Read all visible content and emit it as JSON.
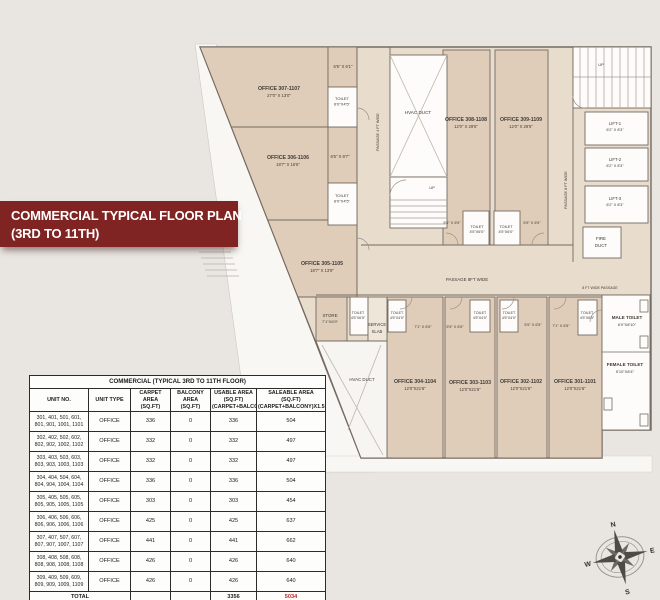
{
  "banner": {
    "line1": "COMMERCIAL TYPICAL FLOOR PLAN",
    "line2": "(3RD TO 11TH)"
  },
  "table": {
    "title": "COMMERCIAL (TYPICAL 3RD TO 11TH FLOOR)",
    "columns": [
      [
        "UNIT NO.",
        ""
      ],
      [
        "UNIT TYPE",
        ""
      ],
      [
        "CARPET AREA",
        "(SQ.FT)"
      ],
      [
        "BALCONY AREA",
        "(SQ.FT)"
      ],
      [
        "USABLE AREA (SQ.FT)",
        "(CARPET+BALCONY)"
      ],
      [
        "SALEABLE AREA (SQ.FT)",
        "(CARPET+BALCONY)X1.5"
      ]
    ],
    "rows": [
      {
        "units": "301, 401, 501, 601, 801, 901, 1001, 1101",
        "type": "OFFICE",
        "carpet": "336",
        "balcony": "0",
        "usable": "336",
        "saleable": "504"
      },
      {
        "units": "302, 402, 502, 602, 802, 902, 1002, 1102",
        "type": "OFFICE",
        "carpet": "332",
        "balcony": "0",
        "usable": "332",
        "saleable": "497"
      },
      {
        "units": "303, 403, 503, 603, 803, 903, 1003, 1103",
        "type": "OFFICE",
        "carpet": "332",
        "balcony": "0",
        "usable": "332",
        "saleable": "497"
      },
      {
        "units": "304, 404, 504, 604, 804, 904, 1004, 1104",
        "type": "OFFICE",
        "carpet": "336",
        "balcony": "0",
        "usable": "336",
        "saleable": "504"
      },
      {
        "units": "305, 405, 505, 605, 805, 905, 1005, 1105",
        "type": "OFFICE",
        "carpet": "303",
        "balcony": "0",
        "usable": "303",
        "saleable": "454"
      },
      {
        "units": "306, 406, 506, 606, 806, 906, 1006, 1106",
        "type": "OFFICE",
        "carpet": "425",
        "balcony": "0",
        "usable": "425",
        "saleable": "637"
      },
      {
        "units": "307, 407, 507, 607, 807, 907, 1007, 1107",
        "type": "OFFICE",
        "carpet": "441",
        "balcony": "0",
        "usable": "441",
        "saleable": "662"
      },
      {
        "units": "308, 408, 508, 608, 808, 908, 1008, 1108",
        "type": "OFFICE",
        "carpet": "426",
        "balcony": "0",
        "usable": "426",
        "saleable": "640"
      },
      {
        "units": "309, 409, 509, 609, 809, 909, 1009, 1109",
        "type": "OFFICE",
        "carpet": "426",
        "balcony": "0",
        "usable": "426",
        "saleable": "640"
      }
    ],
    "total": {
      "label": "TOTAL",
      "usable": "3356",
      "saleable": "5034"
    }
  },
  "plan": {
    "labels": [
      {
        "n": "dim-307-nook",
        "t": "6'5\" X 6'1\"",
        "x": 343,
        "y": 68,
        "s": 4.2
      },
      {
        "n": "office-307-name",
        "t": "OFFICE 307-1107",
        "x": 279,
        "y": 90,
        "s": 5.2,
        "b": 1
      },
      {
        "n": "office-307-dim",
        "t": "27'0\" X 13'0\"",
        "x": 279,
        "y": 97,
        "s": 4.2
      },
      {
        "n": "toilet-307-name",
        "t": "TOILET",
        "x": 342,
        "y": 100,
        "s": 4
      },
      {
        "n": "toilet-307-dim",
        "t": "6'0\"X4'5\"",
        "x": 342,
        "y": 105.5,
        "s": 4
      },
      {
        "n": "office-306-name",
        "t": "OFFICE 306-1106",
        "x": 288,
        "y": 159,
        "s": 5.2,
        "b": 1
      },
      {
        "n": "office-306-dim",
        "t": "18'7\" X 16'5\"",
        "x": 288,
        "y": 166,
        "s": 4.2
      },
      {
        "n": "dim-306-nook",
        "t": "6'5\" X 9'7\"",
        "x": 340,
        "y": 158,
        "s": 4.2
      },
      {
        "n": "toilet-306-name",
        "t": "TOILET",
        "x": 342,
        "y": 197,
        "s": 4
      },
      {
        "n": "toilet-306-dim",
        "t": "6'0\"X4'5\"",
        "x": 342,
        "y": 202.5,
        "s": 4
      },
      {
        "n": "office-305-name",
        "t": "OFFICE 305-1105",
        "x": 322,
        "y": 265,
        "s": 5.2,
        "b": 1
      },
      {
        "n": "office-305-dim",
        "t": "18'7\" X 13'9\"",
        "x": 322,
        "y": 272,
        "s": 4.2
      },
      {
        "n": "hvac-duct-top-label",
        "t": "HVAC DUCT",
        "x": 418,
        "y": 114,
        "s": 4.6
      },
      {
        "n": "stairs-mid-up-label",
        "t": "UP",
        "x": 432,
        "y": 189,
        "s": 4
      },
      {
        "n": "passage-4ft-label",
        "t": "PASSAGE 4 FT WIDE",
        "x": 379,
        "y": 132,
        "s": 3.8,
        "r": -90
      },
      {
        "n": "office-308-name",
        "t": "OFFICE 308-1108",
        "x": 466,
        "y": 121,
        "s": 5.2,
        "b": 1
      },
      {
        "n": "office-308-dim",
        "t": "12'0\" X 29'5\"",
        "x": 466,
        "y": 128,
        "s": 4.2
      },
      {
        "n": "office-309-name",
        "t": "OFFICE 309-1109",
        "x": 521,
        "y": 121,
        "s": 5.2,
        "b": 1
      },
      {
        "n": "office-309-dim",
        "t": "12'0\" X 29'5\"",
        "x": 521,
        "y": 128,
        "s": 4.2
      },
      {
        "n": "passage-8ft-vert-label",
        "t": "PASSAGE 8 FT WIDE",
        "x": 567,
        "y": 190,
        "s": 3.8,
        "r": -90
      },
      {
        "n": "stairs-top-up-label",
        "t": "UP",
        "x": 601,
        "y": 66,
        "s": 4
      },
      {
        "n": "lift-1-name",
        "t": "LIFT-1",
        "x": 615,
        "y": 125,
        "s": 4.2
      },
      {
        "n": "lift-1-dim",
        "t": "6'2\" X 8'3\"",
        "x": 615,
        "y": 131,
        "s": 3.8
      },
      {
        "n": "lift-2-name",
        "t": "LIFT-2",
        "x": 615,
        "y": 161,
        "s": 4.2
      },
      {
        "n": "lift-2-dim",
        "t": "6'2\" X 8'3\"",
        "x": 615,
        "y": 167,
        "s": 3.8
      },
      {
        "n": "lift-3-name",
        "t": "LIFT-3",
        "x": 615,
        "y": 200,
        "s": 4.2
      },
      {
        "n": "lift-3-dim",
        "t": "6'2\" X 8'3\"",
        "x": 615,
        "y": 206,
        "s": 3.8
      },
      {
        "n": "fire-duct-line1",
        "t": "FIRE",
        "x": 601,
        "y": 240,
        "s": 4.4
      },
      {
        "n": "fire-duct-line2",
        "t": "DUCT",
        "x": 601,
        "y": 247,
        "s": 4.4
      },
      {
        "n": "dim-308-left",
        "t": "5'5\" X 6'5\"",
        "x": 452,
        "y": 224,
        "s": 3.8
      },
      {
        "n": "toilet-308-name",
        "t": "TOILET",
        "x": 477,
        "y": 228,
        "s": 3.8
      },
      {
        "n": "toilet-308-dim",
        "t": "4'5\"X6'0\"",
        "x": 477,
        "y": 233,
        "s": 3.8
      },
      {
        "n": "toilet-309-name",
        "t": "TOILET",
        "x": 506,
        "y": 228,
        "s": 3.8
      },
      {
        "n": "toilet-309-dim",
        "t": "4'5\"X6'0\"",
        "x": 506,
        "y": 233,
        "s": 3.8
      },
      {
        "n": "dim-309-right",
        "t": "5'5\" X 6'5\"",
        "x": 532,
        "y": 224,
        "s": 3.8
      },
      {
        "n": "passage-8ft-horiz-label",
        "t": "PASSAGE 8FT WIDE",
        "x": 467,
        "y": 281,
        "s": 4.4
      },
      {
        "n": "passage-8ft-right-label",
        "t": "8 FT WIDE PASSAGE",
        "x": 600,
        "y": 289,
        "s": 3.6
      },
      {
        "n": "store-name",
        "t": "STORE",
        "x": 330,
        "y": 317,
        "s": 4.4
      },
      {
        "n": "store-dim",
        "t": "7'1\"X6'9\"",
        "x": 330,
        "y": 323,
        "s": 4
      },
      {
        "n": "toilet-store-name",
        "t": "TOILET",
        "x": 358,
        "y": 314,
        "s": 3.6
      },
      {
        "n": "toilet-store-dim",
        "t": "4'5\"X6'5\"",
        "x": 358,
        "y": 319,
        "s": 3.6
      },
      {
        "n": "service-slab-line1",
        "t": "SERVICE",
        "x": 377,
        "y": 326,
        "s": 4.2
      },
      {
        "n": "service-slab-line2",
        "t": "SLAB",
        "x": 377,
        "y": 333,
        "s": 4.2
      },
      {
        "n": "toilet-304-name",
        "t": "TOILET",
        "x": 397,
        "y": 314,
        "s": 3.6
      },
      {
        "n": "toilet-304-dim",
        "t": "4'5\"X4'0\"",
        "x": 397,
        "y": 319,
        "s": 3.6
      },
      {
        "n": "dim-304",
        "t": "7'1\" X 6'5\"",
        "x": 423,
        "y": 328,
        "s": 3.8
      },
      {
        "n": "dim-303",
        "t": "5'5\" X 6'5\"",
        "x": 455,
        "y": 328,
        "s": 3.8
      },
      {
        "n": "toilet-303-name",
        "t": "TOILET",
        "x": 480,
        "y": 314,
        "s": 3.6
      },
      {
        "n": "toilet-303-dim",
        "t": "4'5\"X4'0\"",
        "x": 480,
        "y": 319,
        "s": 3.6
      },
      {
        "n": "toilet-302-name",
        "t": "TOILET",
        "x": 509,
        "y": 314,
        "s": 3.6
      },
      {
        "n": "toilet-302-dim",
        "t": "4'5\"X4'0\"",
        "x": 509,
        "y": 319,
        "s": 3.6
      },
      {
        "n": "dim-302",
        "t": "5'5\" X 6'5\"",
        "x": 533,
        "y": 326,
        "s": 3.8
      },
      {
        "n": "dim-301",
        "t": "7'1\" X 6'5\"",
        "x": 561,
        "y": 327,
        "s": 3.8
      },
      {
        "n": "toilet-301-name",
        "t": "TOILET",
        "x": 587,
        "y": 314,
        "s": 3.6
      },
      {
        "n": "toilet-301-dim",
        "t": "4'5\"X6'5\"",
        "x": 587,
        "y": 319,
        "s": 3.6
      },
      {
        "n": "male-toilet-name",
        "t": "MALE TOILET",
        "x": 627,
        "y": 319,
        "s": 4.6,
        "b": 1
      },
      {
        "n": "male-toilet-dim",
        "t": "6'0\"X8'10\"",
        "x": 627,
        "y": 326,
        "s": 4
      },
      {
        "n": "female-toilet-name",
        "t": "FEMALE TOILET",
        "x": 625,
        "y": 366,
        "s": 4.6,
        "b": 1
      },
      {
        "n": "female-toilet-dim",
        "t": "5'10\"X8'4\"",
        "x": 625,
        "y": 373,
        "s": 4
      },
      {
        "n": "hvac-duct-bottom-label",
        "t": "HVAC DUCT",
        "x": 362,
        "y": 381,
        "s": 4.4
      },
      {
        "n": "office-304-name",
        "t": "OFFICE 304-1104",
        "x": 415,
        "y": 383,
        "s": 5.2,
        "b": 1
      },
      {
        "n": "office-304-dim",
        "t": "12'0\"X21'6\"",
        "x": 415,
        "y": 390,
        "s": 4.2
      },
      {
        "n": "office-303-name",
        "t": "OFFICE 303-1103",
        "x": 470,
        "y": 384,
        "s": 5.2,
        "b": 1
      },
      {
        "n": "office-303-dim",
        "t": "12'0\"X21'6\"",
        "x": 470,
        "y": 391,
        "s": 4.2
      },
      {
        "n": "office-302-name",
        "t": "OFFICE 302-1102",
        "x": 521,
        "y": 383,
        "s": 5.2,
        "b": 1
      },
      {
        "n": "office-302-dim",
        "t": "12'0\"X21'6\"",
        "x": 521,
        "y": 390,
        "s": 4.2
      },
      {
        "n": "office-301-name",
        "t": "OFFICE 301-1101",
        "x": 575,
        "y": 383,
        "s": 5.2,
        "b": 1
      },
      {
        "n": "office-301-dim",
        "t": "12'0\"X21'6\"",
        "x": 575,
        "y": 390,
        "s": 4.2
      }
    ]
  },
  "compass": {
    "n": "N",
    "e": "E",
    "s": "S",
    "w": "W"
  },
  "colors": {
    "banner_red": "#802423",
    "page_bg": "#e9e6e2",
    "passage_beige": "#e8dccd",
    "office_tan": "#e0cdb9",
    "room_white": "#fdfcfa",
    "wall": "#756a61",
    "total_red": "#c0251f"
  }
}
